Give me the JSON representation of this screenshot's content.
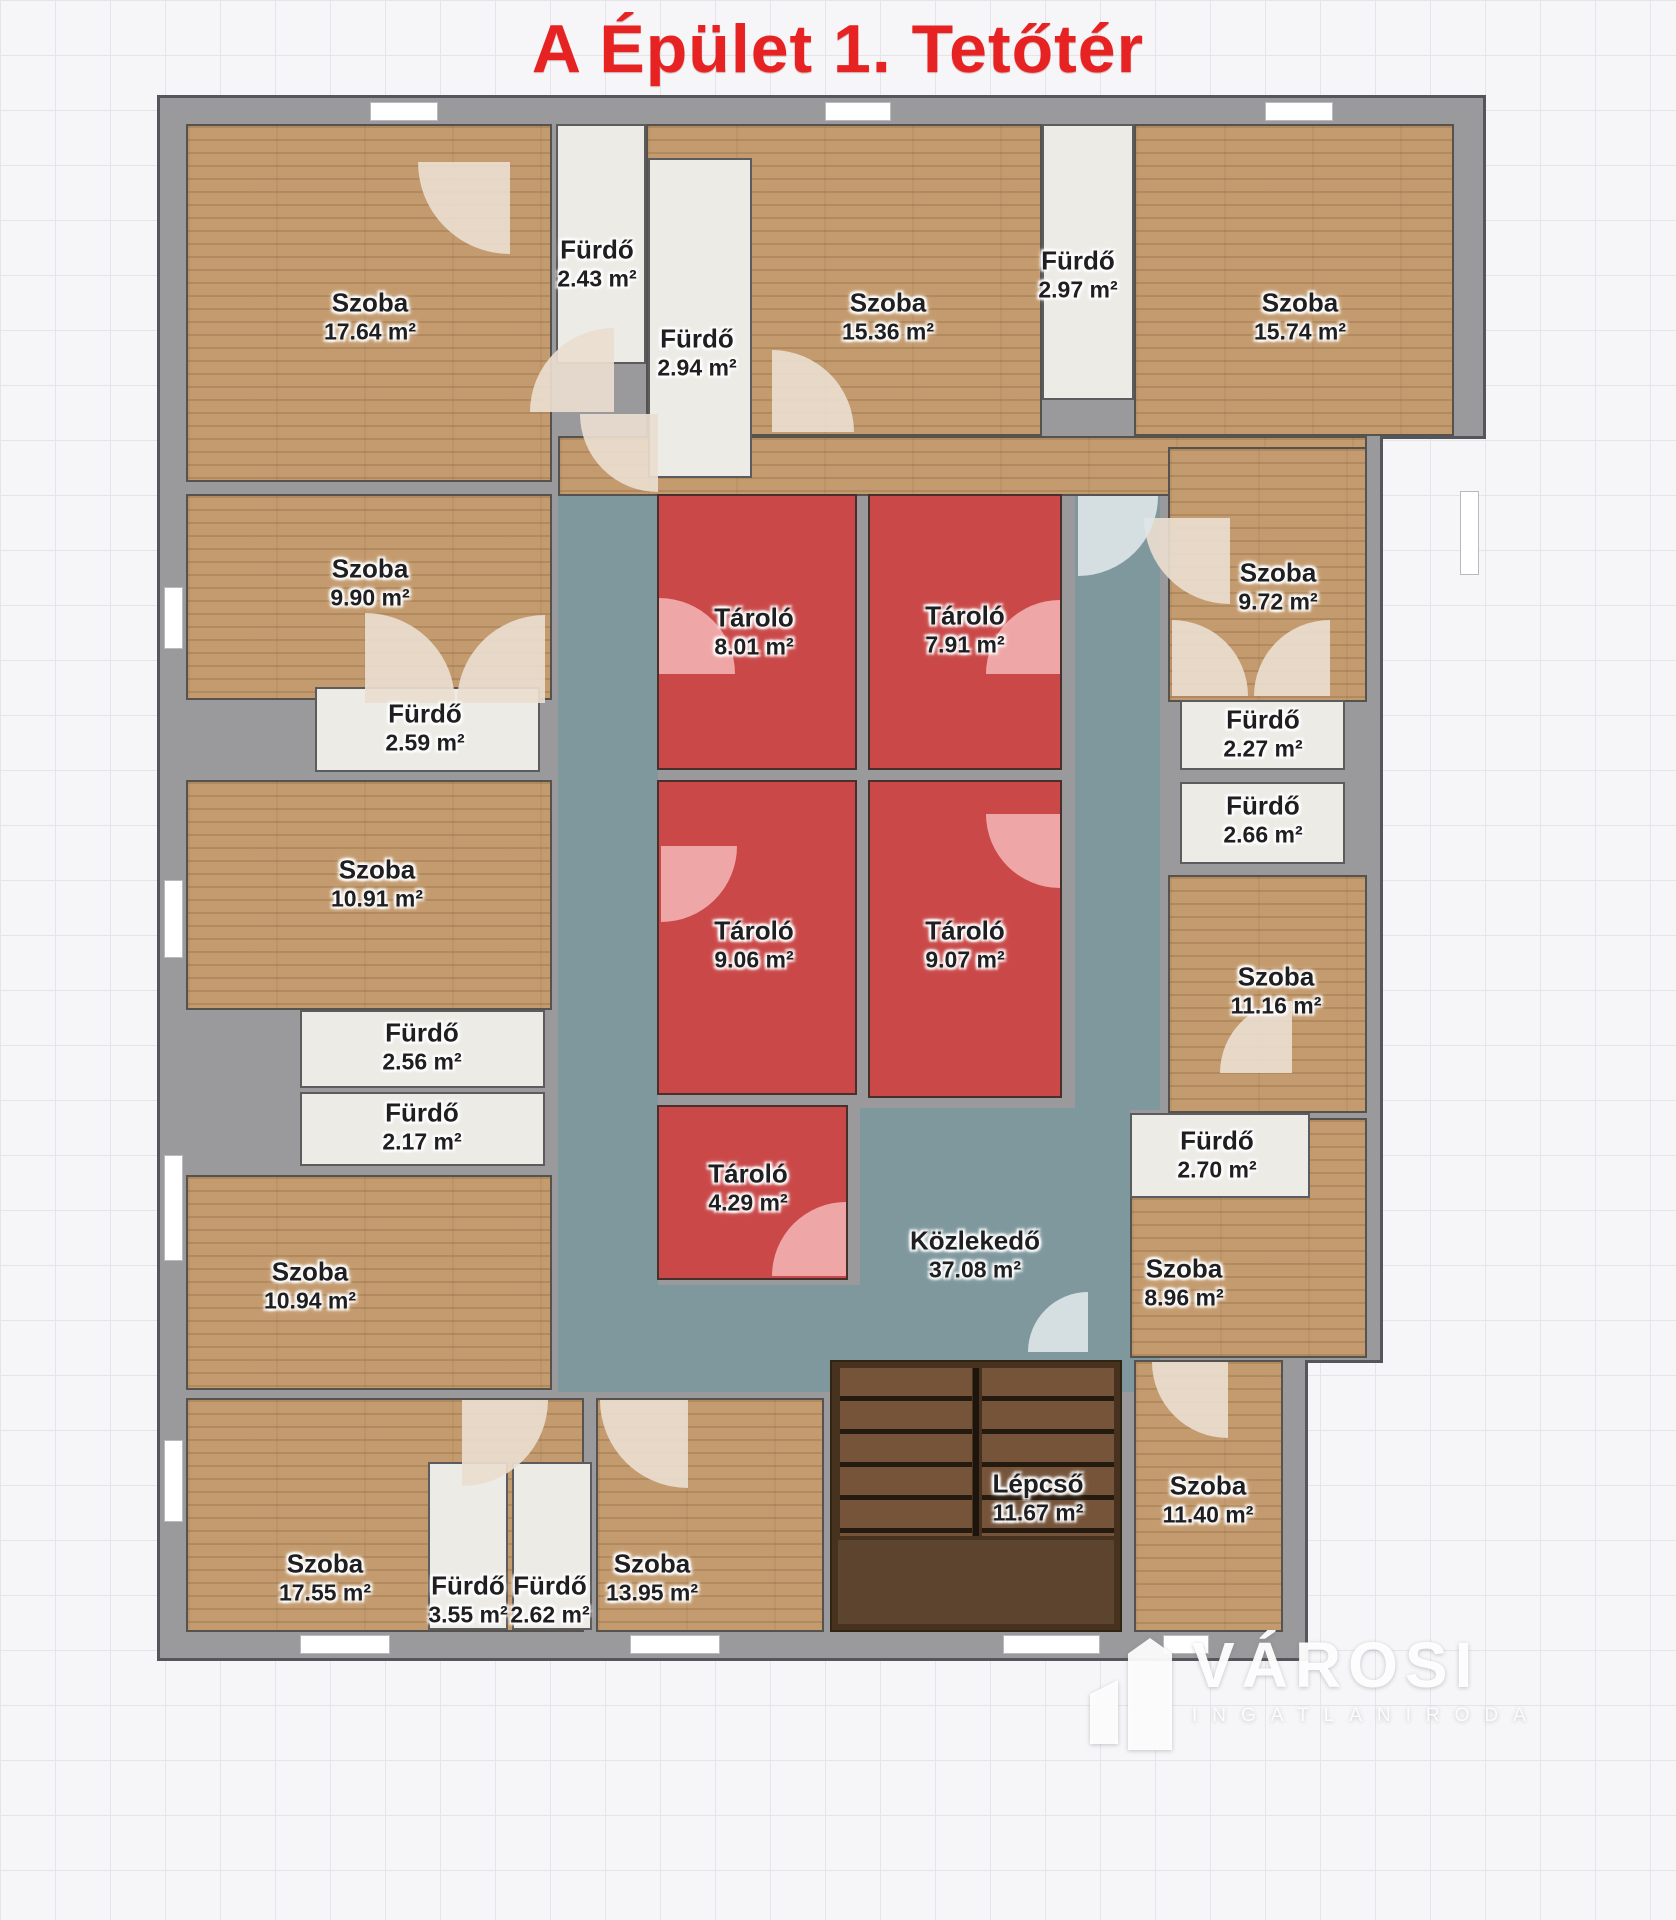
{
  "title": "A Épület 1. Tetőtér",
  "floor_type": "floor-plan",
  "colors": {
    "title": "#e62222",
    "wall": "#9a999c",
    "room_wood": "#c49b6e",
    "bathroom": "#edebe6",
    "storage_red": "#ca4848",
    "corridor_teal": "#7e989e",
    "stairs_brown": "#47311f",
    "background_grid": "#f6f6f8"
  },
  "rooms": [
    {
      "name": "Szoba",
      "area": "17.64 m²"
    },
    {
      "name": "Fürdő",
      "area": "2.43 m²"
    },
    {
      "name": "Fürdő",
      "area": "2.94 m²"
    },
    {
      "name": "Szoba",
      "area": "15.36 m²"
    },
    {
      "name": "Fürdő",
      "area": "2.97 m²"
    },
    {
      "name": "Szoba",
      "area": "15.74 m²"
    },
    {
      "name": "Szoba",
      "area": "9.90 m²"
    },
    {
      "name": "Fürdő",
      "area": "2.59 m²"
    },
    {
      "name": "Szoba",
      "area": "10.91 m²"
    },
    {
      "name": "Fürdő",
      "area": "2.56 m²"
    },
    {
      "name": "Fürdő",
      "area": "2.17 m²"
    },
    {
      "name": "Szoba",
      "area": "10.94 m²"
    },
    {
      "name": "Tároló",
      "area": "8.01 m²"
    },
    {
      "name": "Tároló",
      "area": "7.91 m²"
    },
    {
      "name": "Tároló",
      "area": "9.06 m²"
    },
    {
      "name": "Tároló",
      "area": "9.07 m²"
    },
    {
      "name": "Tároló",
      "area": "4.29 m²"
    },
    {
      "name": "Közlekedő",
      "area": "37.08 m²"
    },
    {
      "name": "Szoba",
      "area": "9.72 m²"
    },
    {
      "name": "Fürdő",
      "area": "2.27 m²"
    },
    {
      "name": "Fürdő",
      "area": "2.66 m²"
    },
    {
      "name": "Szoba",
      "area": "11.16 m²"
    },
    {
      "name": "Fürdő",
      "area": "2.70 m²"
    },
    {
      "name": "Szoba",
      "area": "8.96 m²"
    },
    {
      "name": "Szoba",
      "area": "17.55 m²"
    },
    {
      "name": "Fürdő",
      "area": "3.55 m²"
    },
    {
      "name": "Fürdő",
      "area": "2.62 m²"
    },
    {
      "name": "Szoba",
      "area": "13.95 m²"
    },
    {
      "name": "Lépcső",
      "area": "11.67 m²"
    },
    {
      "name": "Szoba",
      "area": "11.40 m²"
    }
  ],
  "watermark": {
    "brand": "VÁROSI",
    "subtitle": "INGATLANIRODA"
  }
}
